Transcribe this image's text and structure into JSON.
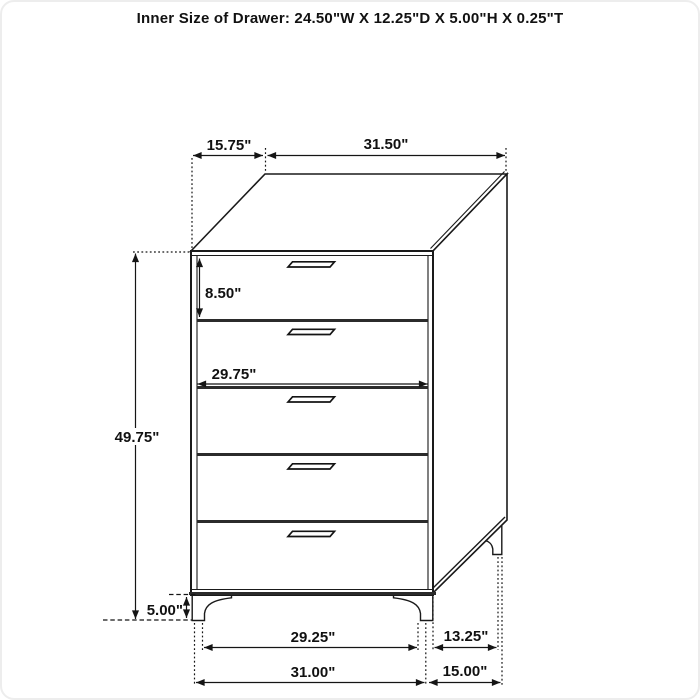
{
  "title": "Inner Size of Drawer: 24.50\"W X 12.25\"D X 5.00\"H X 0.25\"T",
  "diagram": {
    "object": "five-drawer-chest-dimension-diagram",
    "drawer_count": 5,
    "labels": {
      "top_depth": "15.75\"",
      "top_width": "31.50\"",
      "drawer_height": "8.50\"",
      "inner_width": "29.75\"",
      "total_height": "49.75\"",
      "leg_height": "5.00\"",
      "front_leg_span": "29.25\"",
      "side_leg_span": "13.25\"",
      "front_base_width": "31.00\"",
      "side_base_depth": "15.00\""
    },
    "inner_drawer_size": {
      "width": "24.50\"",
      "depth": "12.25\"",
      "height": "5.00\"",
      "thickness": "0.25\""
    }
  },
  "colors": {
    "background": "#ffffff",
    "line": "#1a1a1a",
    "text": "#111111"
  }
}
